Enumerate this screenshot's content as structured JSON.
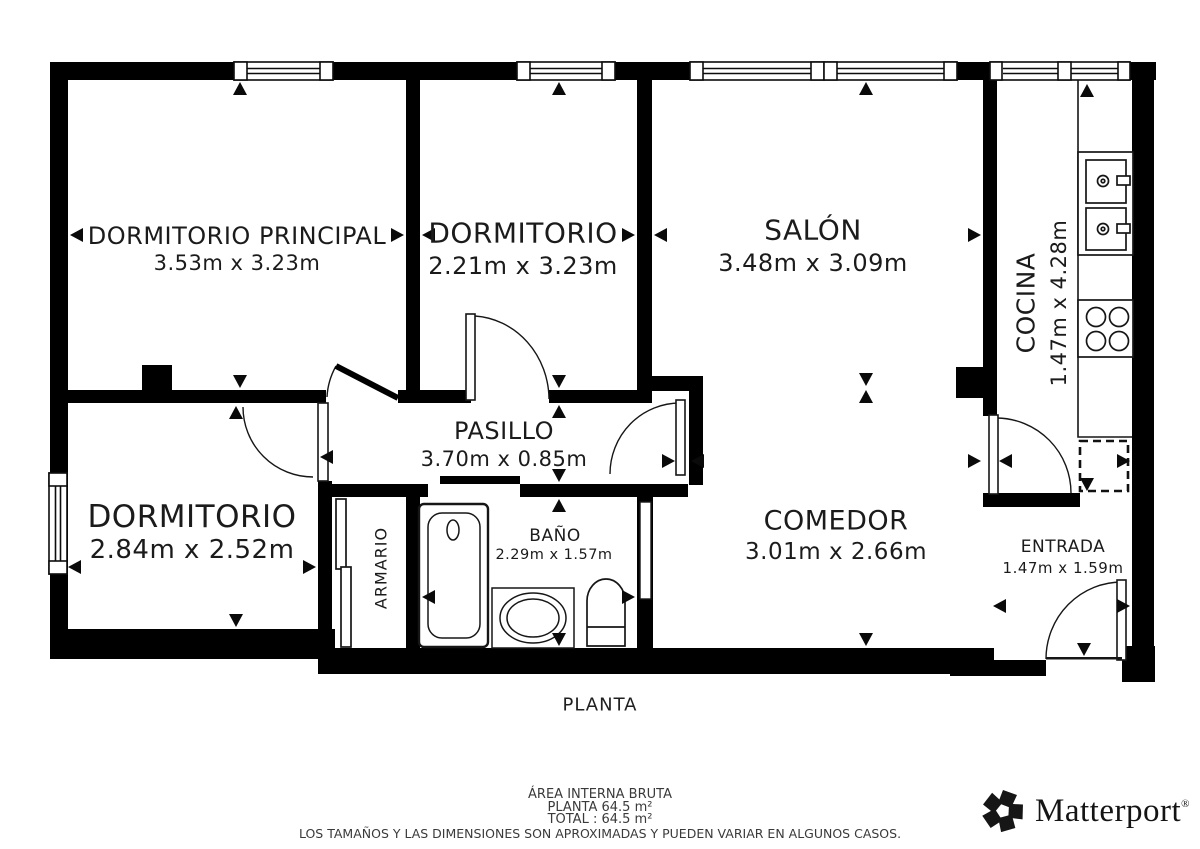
{
  "plan": {
    "title": "PLANTA",
    "rooms": {
      "dormitorio_principal": {
        "label": "DORMITORIO PRINCIPAL",
        "dims": "3.53m x 3.23m"
      },
      "dormitorio_top": {
        "label": "DORMITORIO",
        "dims": "2.21m x 3.23m"
      },
      "salon": {
        "label": "SALÓN",
        "dims": "3.48m x 3.09m"
      },
      "cocina": {
        "label": "COCINA",
        "dims": "1.47m x 4.28m"
      },
      "pasillo": {
        "label": "PASILLO",
        "dims": "3.70m x 0.85m"
      },
      "dormitorio_bottom": {
        "label": "DORMITORIO",
        "dims": "2.84m x 2.52m"
      },
      "armario": {
        "label": "ARMARIO"
      },
      "bano": {
        "label": "BAÑO",
        "dims": "2.29m x 1.57m"
      },
      "comedor": {
        "label": "COMEDOR",
        "dims": "3.01m x 2.66m"
      },
      "entrada": {
        "label": "ENTRADA",
        "dims": "1.47m x 1.59m"
      }
    }
  },
  "footer": {
    "area_title": "ÁREA INTERNA BRUTA",
    "planta_area": "PLANTA 64.5 m²",
    "total_area": "TOTAL :  64.5 m²",
    "disclaimer": "LOS TAMAÑOS Y LAS DIMENSIONES SON APROXIMADAS Y PUEDEN VARIAR EN ALGUNOS CASOS."
  },
  "branding": {
    "logo_text": "Matterport",
    "registered_mark": "®"
  },
  "colors": {
    "wall": "#000000",
    "line": "#111111",
    "text": "#1b1b1b",
    "footer_text": "#3a3a3a"
  }
}
